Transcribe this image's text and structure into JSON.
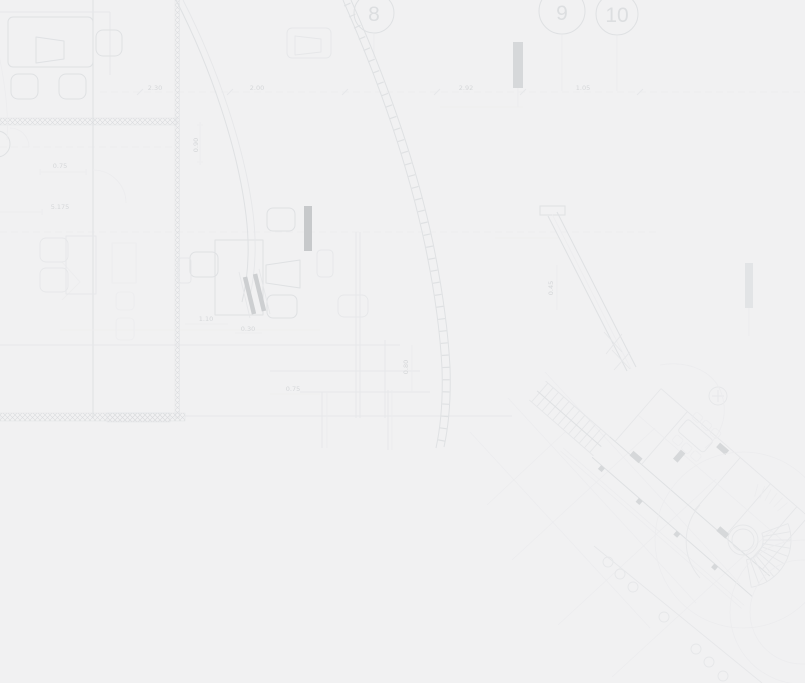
{
  "colors": {
    "background": "#f1f1f2",
    "line_faint": "#ececee",
    "line_light": "#e6e7e9",
    "line_mid": "#dfe1e3",
    "line_strong": "#d7d9db",
    "hatch": "#d9dbdd",
    "column_dark": "#c7c9cb",
    "column_mid": "#d6d8da",
    "column_light": "#e2e4e6",
    "text_dim": "#d5d7d9",
    "text_bubble": "#dcdee0"
  },
  "grid_bubbles": [
    {
      "label": "8"
    },
    {
      "label": "9"
    },
    {
      "label": "10"
    }
  ],
  "dimensions": [
    "2.30",
    "2.00",
    "2.92",
    "1.05",
    "0.75",
    "5.175",
    "0.90",
    "1.10",
    "0.30",
    "0.75",
    "0.80",
    "0.45"
  ]
}
